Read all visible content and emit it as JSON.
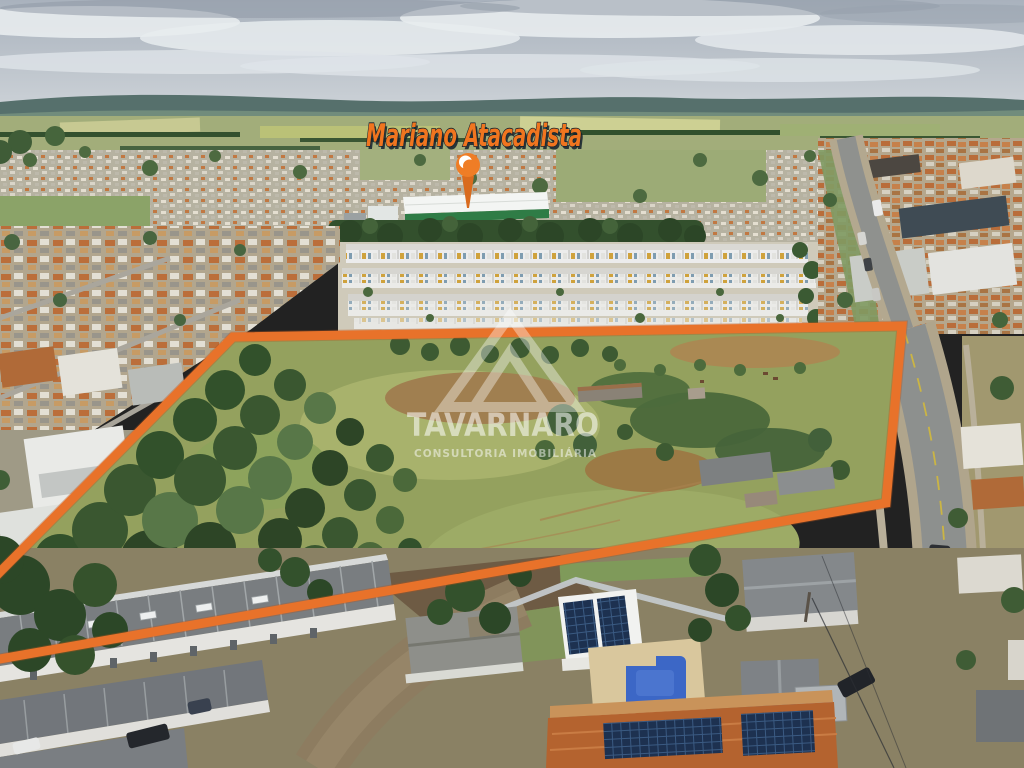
{
  "meta": {
    "type": "aerial-drone-photograph",
    "subject": "Land parcel for sale outlined in orange beside residential neighborhood and highway"
  },
  "annotations": {
    "poi_label": "Mariano Atacadista",
    "poi_pin_icon": "map-pin",
    "boundary_shape": "orange-polygon-outline"
  },
  "watermark": {
    "brand": "TAVARNARO",
    "tagline": "CONSULTORIA IMOBILIÁRIA",
    "logo_icon": "triangle-mountain"
  },
  "colors": {
    "boundary_orange": "#E8722A",
    "label_orange": "#F0751F",
    "label_outline": "#14212D",
    "pin_orange": "#EF7D26",
    "watermark_white": "#FFFFFF",
    "warehouse_green": "#2F7C46",
    "field_green": "#94A15E",
    "pool_blue": "#3C67C6"
  }
}
